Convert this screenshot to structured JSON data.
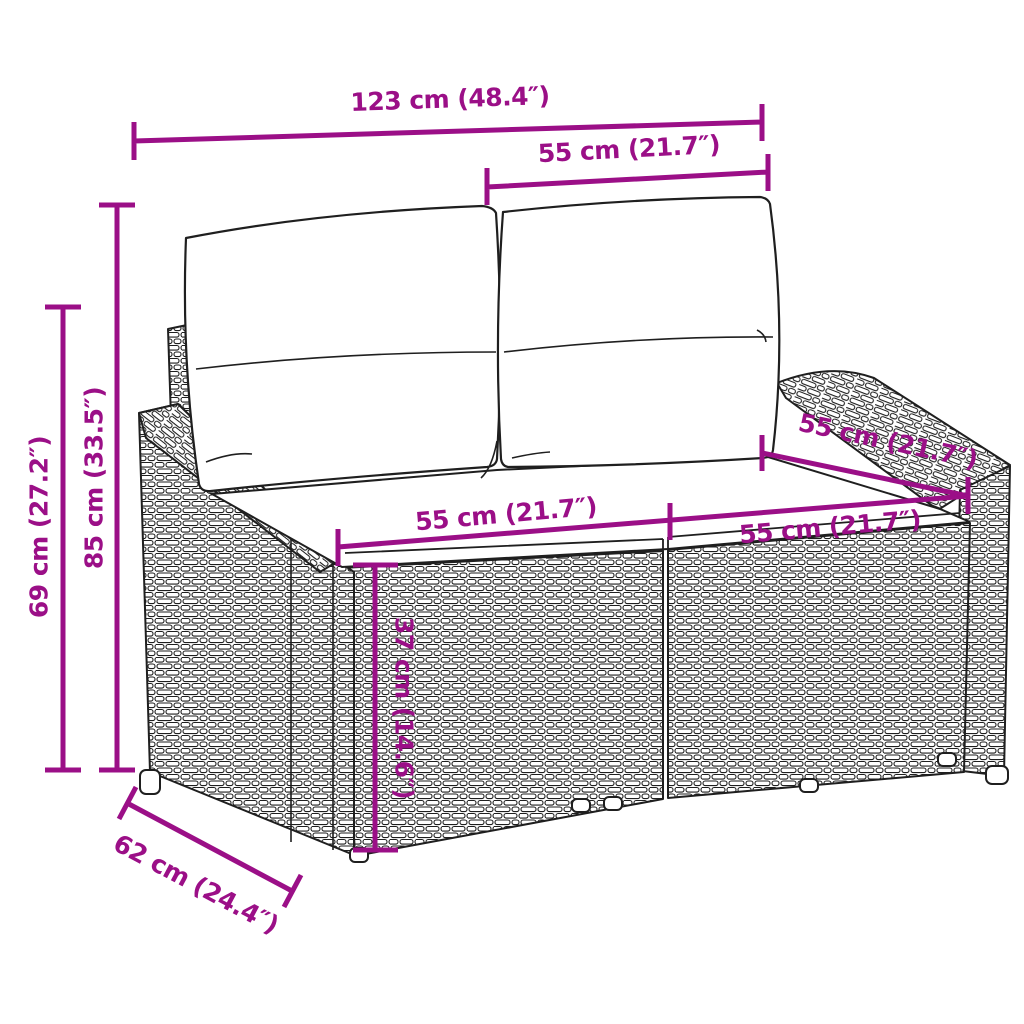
{
  "figure": {
    "subject": "Black line-art drawing of a two-seater poly rattan garden sofa with two back cushions and two seat cushions, annotated with magenta dimension lines"
  },
  "colors": {
    "dimension": "#9B0F87",
    "line_art": "#1f1f1f",
    "background": "#ffffff"
  },
  "dimensions": {
    "width_total": {
      "label": "123 cm (48.4″)"
    },
    "back_width": {
      "label": "55 cm (21.7″)"
    },
    "height_total": {
      "label": "85 cm (33.5″)"
    },
    "arm_height": {
      "label": "69 cm (27.2″)"
    },
    "seat_width_left": {
      "label": "55 cm (21.7″)"
    },
    "seat_width_right": {
      "label": "55 cm (21.7″)"
    },
    "seat_depth": {
      "label": "55 cm (21.7″)"
    },
    "seat_height": {
      "label": "37 cm (14.6″)"
    },
    "depth_total": {
      "label": "62 cm (24.4″)"
    }
  }
}
